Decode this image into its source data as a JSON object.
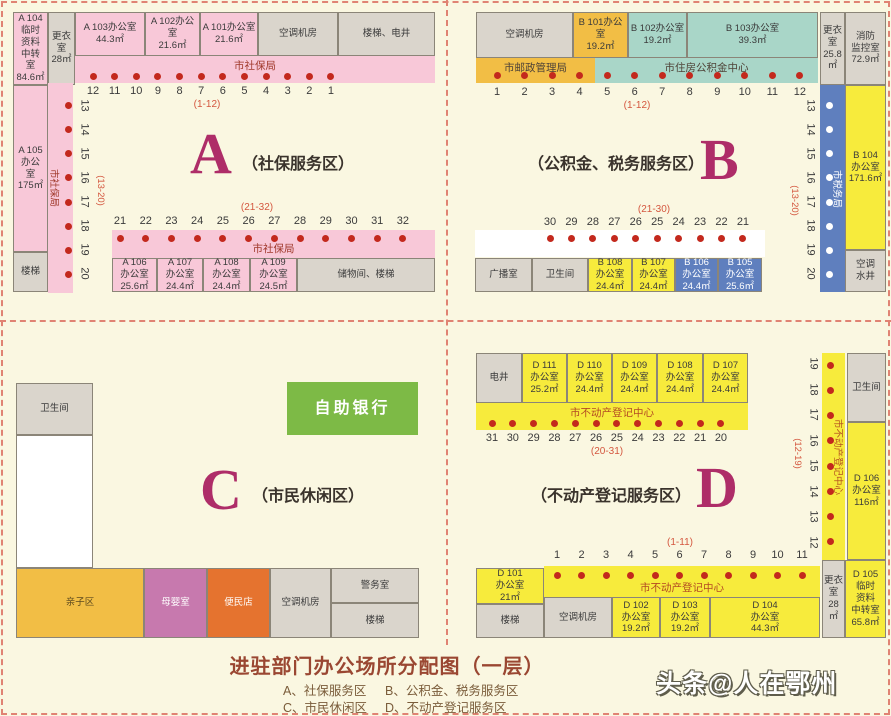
{
  "palette": {
    "background": "#FAF7E1",
    "pink": "#F8C8D8",
    "gray": "#DAD5CC",
    "amber": "#F2BE45",
    "teal": "#A9D6C8",
    "blue": "#5F7FBE",
    "yellow": "#F7EB3C",
    "green": "#7DBA46",
    "violet": "#C779AE",
    "deep_orange": "#E5732F",
    "dot_red": "#C3291D",
    "zone_letter_magenta": "#AE2D68",
    "dashed_line_red": "#E08373"
  },
  "zoneA": {
    "letter": "A",
    "title": "（社保服务区）",
    "room_a104": "A 104\n临时\n资料\n中转\n室\n84.6㎡",
    "dressing_room": "更衣\n室\n28㎡",
    "room_a103": "A 103办公室\n44.3㎡",
    "room_a102": "A 102办公室\n21.6㎡",
    "room_a101": "A 101办公室\n21.6㎡",
    "ac_room": "空调机房",
    "stairs_shaft": "楼梯、电井",
    "band_top": "市社保局",
    "numbers_top": "12 11 10 9 8 7 6 5 4 3 2 1",
    "range_top": "(1-12)",
    "room_a105": "A 105\n办公\n室\n175㎡",
    "stairs_left": "楼梯",
    "band_left": "市社保局",
    "numbers_left": "13 14 15 16 17 18 19 20",
    "range_left": "(13-20)",
    "range_bottom": "(21-32)",
    "numbers_bottom": "21 22 23 24 25 26 27 28 29 30 31 32",
    "band_bottom": "市社保局",
    "room_a106": "A 106\n办公室\n25.6㎡",
    "room_a107": "A 107\n办公室\n24.4㎡",
    "room_a108": "A 108\n办公室\n24.4㎡",
    "room_a109": "A 109\n办公室\n24.5㎡",
    "storage_stairs": "储物间、楼梯"
  },
  "zoneB": {
    "letter": "B",
    "title": "（公积金、税务服务区）",
    "ac_room": "空调机房",
    "room_b101": "B 101办公室\n19.2㎡",
    "room_b102": "B 102办公室\n19.2㎡",
    "room_b103": "B 103办公室\n39.3㎡",
    "dressing_room": "更衣\n室\n25.8㎡",
    "fire_control": "消防\n监控室\n72.9㎡",
    "band_post": "市邮政管理局",
    "band_fund": "市住房公积金中心",
    "numbers_top": "1 2 3 4 5 6 7 8 9 10 11 12",
    "range_top": "(1-12)",
    "band_tax": "市税务局",
    "numbers_right": "13 14 15 16 17 18 19 20",
    "range_right": "(13-20)",
    "room_b104": "B 104\n办公室\n171.6㎡",
    "ac_well": "空调\n水井",
    "range_bottom": "(21-30)",
    "numbers_bottom": "30 29 28 27 26 25 24 23 22 21",
    "broadcast_room": "广播室",
    "toilet": "卫生间",
    "room_b108": "B 108\n办公室\n24.4㎡",
    "room_b107": "B 107\n办公室\n24.4㎡",
    "room_b106": "B 106\n办公室\n24.4㎡",
    "room_b105": "B 105\n办公室\n25.6㎡"
  },
  "zoneC": {
    "letter": "C",
    "title": "（市民休闲区）",
    "toilet": "卫生间",
    "self_bank": "自助银行",
    "kids_area": "亲子区",
    "nursing_room": "母婴室",
    "convenience_store": "便民店",
    "ac_room": "空调机房",
    "police_room": "警务室",
    "stairs": "楼梯"
  },
  "zoneD": {
    "letter": "D",
    "title": "（不动产登记服务区）",
    "shaft": "电井",
    "room_d111": "D 111\n办公室\n25.2㎡",
    "room_d110": "D 110\n办公室\n24.4㎡",
    "room_d109": "D 109\n办公室\n24.4㎡",
    "room_d108": "D 108\n办公室\n24.4㎡",
    "room_d107": "D 107\n办公室\n24.4㎡",
    "band_top": "市不动产登记中心",
    "numbers_top": "31 30 29 28 27 26 25 24 23 22 21 20",
    "range_top": "(20-31)",
    "band_right": "市不动产登记中心",
    "numbers_right": "19 18 17 16 15 14 13 12",
    "range_right": "(12-19)",
    "toilet": "卫生间",
    "room_d106": "D 106\n办公室\n116㎡",
    "range_bottom": "(1-11)",
    "numbers_bottom": "1 2 3 4 5 6 7 8 9 10 11",
    "room_d101": "D 101\n办公室\n21㎡",
    "stairs": "楼梯",
    "band_bottom": "市不动产登记中心",
    "ac_room": "空调机房",
    "room_d102": "D 102\n办公室\n19.2㎡",
    "room_d103": "D 103\n办公室\n19.2㎡",
    "room_d104": "D 104\n办公室\n44.3㎡",
    "dressing_room": "更衣\n室\n28㎡",
    "room_d105": "D 105\n临时\n资料\n中转室\n65.8㎡"
  },
  "footer": {
    "title": "进驻部门办公场所分配图（一层）",
    "legend_a": "A、社保服务区",
    "legend_b": "B、公积金、税务服务区",
    "legend_c": "C、市民休闲区",
    "legend_d": "D、不动产登记服务区"
  },
  "watermark": "头条@人在鄂州"
}
